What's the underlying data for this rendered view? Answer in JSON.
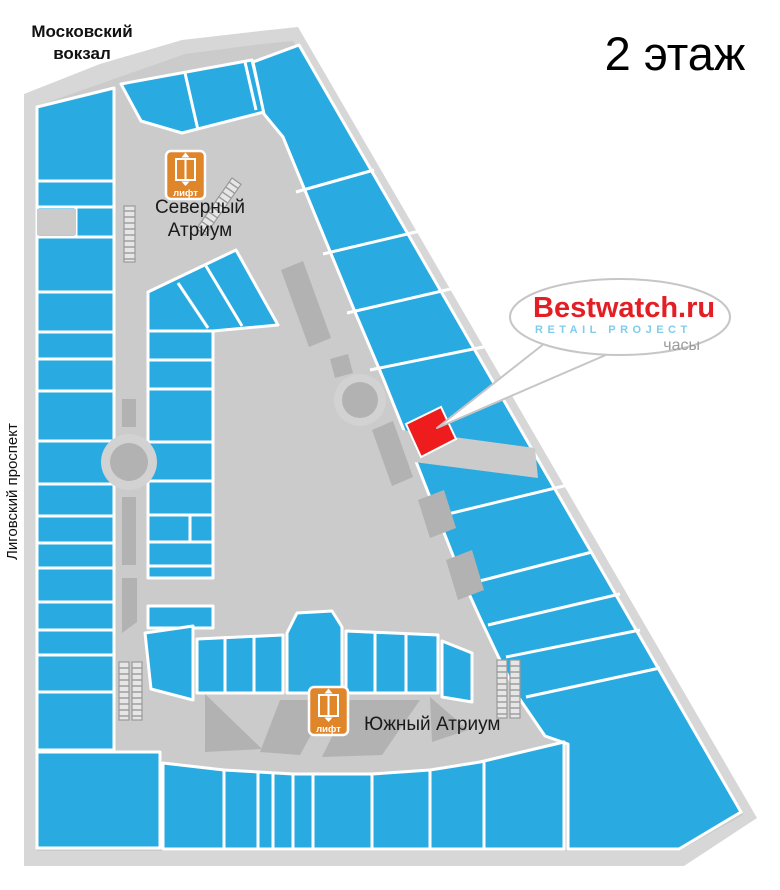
{
  "page": {
    "floor_title": "2 этаж"
  },
  "landmarks": {
    "station_line1": "Московский",
    "station_line2": "вокзал",
    "street": "Лиговский проспект"
  },
  "atriums": {
    "north_line1": "Северный",
    "north_line2": "Атриум",
    "south": "Южный Атриум"
  },
  "elevator": {
    "label": "лифт"
  },
  "callout": {
    "brand": "Bestwatch.ru",
    "subtitle": "RETAIL PROJECT",
    "category": "часы"
  },
  "colors": {
    "store_blue": "#29abe2",
    "corridor_gray": "#cbcbcb",
    "outline_gray": "#d7d7d7",
    "dark_gray": "#b2b2b2",
    "junction_ring": "#d2d2d2",
    "highlight_red": "#ee1c1c",
    "elevator_orange": "#e0862a",
    "brand_red": "#e31e24",
    "brand_blue": "#7fcdea",
    "label_gray": "#9b9b9b"
  }
}
